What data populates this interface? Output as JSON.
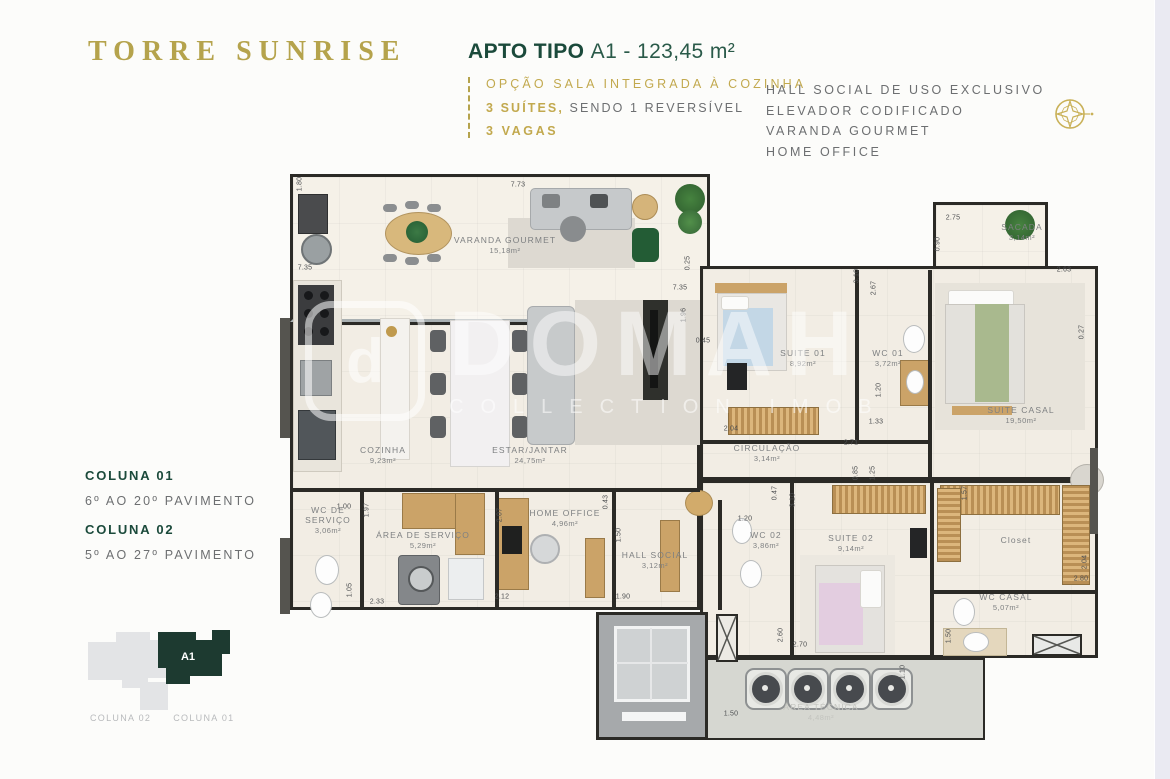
{
  "page": {
    "background": "#fcfcfa",
    "right_strip_color": "#eaeaf2"
  },
  "brand": {
    "title": "TORRE SUNRISE",
    "color": "#b5a34c"
  },
  "header": {
    "apto_label": "APTO TIPO",
    "apto_value": "A1 - 123,45 m²",
    "option_line": "OPÇÃO SALA INTEGRADA À COZINHA",
    "suites_bold": "3 SUÍTES,",
    "suites_rest": "SENDO 1 REVERSÍVEL",
    "vagas_line": "3 VAGAS"
  },
  "features": [
    "HALL SOCIAL DE USO EXCLUSIVO",
    "ELEVADOR CODIFICADO",
    "VARANDA GOURMET",
    "HOME OFFICE"
  ],
  "columns_info": [
    {
      "label": "COLUNA 01",
      "range": "6º AO 20º PAVIMENTO"
    },
    {
      "label": "COLUNA 02",
      "range": "5º AO 27º PAVIMENTO"
    }
  ],
  "keyplan": {
    "unit_label": "A1",
    "unit_color": "#1d3a30",
    "other_color": "#e3e4e6",
    "captions": [
      "COLUNA 02",
      "COLUNA 01"
    ]
  },
  "floorplan": {
    "watermark": {
      "logo_letter": "d",
      "line1": "DOMAH",
      "line2": "COLLECTION IMOB"
    },
    "rooms": [
      {
        "name": "VARANDA GOURMET",
        "area": "15,18m²",
        "x": 225,
        "y": 77
      },
      {
        "name": "SACADA",
        "area": "3,14m²",
        "x": 742,
        "y": 64
      },
      {
        "name": "COZINHA",
        "area": "9,23m²",
        "x": 103,
        "y": 287
      },
      {
        "name": "ESTAR/JANTAR",
        "area": "24,75m²",
        "x": 250,
        "y": 287
      },
      {
        "name": "SUITE 01",
        "area": "8,92m²",
        "x": 523,
        "y": 190
      },
      {
        "name": "WC 01",
        "area": "3,72m²",
        "x": 608,
        "y": 190
      },
      {
        "name": "SUITE CASAL",
        "area": "19,50m²",
        "x": 741,
        "y": 247
      },
      {
        "name": "CIRCULAÇÃO",
        "area": "3,14m²",
        "x": 487,
        "y": 285
      },
      {
        "name": "WC DE SERVIÇO",
        "area": "3,06m²",
        "x": 48,
        "y": 352,
        "wrap": true
      },
      {
        "name": "ÁREA DE SERVIÇO",
        "area": "5,29m²",
        "x": 143,
        "y": 372
      },
      {
        "name": "HOME OFFICE",
        "area": "4,96m²",
        "x": 285,
        "y": 350
      },
      {
        "name": "HALL SOCIAL",
        "area": "3,12m²",
        "x": 375,
        "y": 392
      },
      {
        "name": "WC 02",
        "area": "3,86m²",
        "x": 486,
        "y": 372
      },
      {
        "name": "SUITE 02",
        "area": "9,14m²",
        "x": 571,
        "y": 375
      },
      {
        "name": "Closet",
        "area": "",
        "x": 736,
        "y": 372
      },
      {
        "name": "WC CASAL",
        "area": "5,07m²",
        "x": 726,
        "y": 434
      },
      {
        "name": "ÁREA TÉCNICA",
        "area": "4,48m²",
        "x": 541,
        "y": 544,
        "light": true
      }
    ],
    "dimensions": [
      {
        "t": "1.80",
        "x": 20,
        "y": 16,
        "r": 1
      },
      {
        "t": "7.73",
        "x": 238,
        "y": 17,
        "r": 0
      },
      {
        "t": "7.35",
        "x": 25,
        "y": 100,
        "r": 0
      },
      {
        "t": "0.25",
        "x": 408,
        "y": 95,
        "r": 1
      },
      {
        "t": "7.35",
        "x": 400,
        "y": 120,
        "r": 0
      },
      {
        "t": "1.96",
        "x": 404,
        "y": 147,
        "r": 1
      },
      {
        "t": "2.75",
        "x": 673,
        "y": 50,
        "r": 0
      },
      {
        "t": "0.90",
        "x": 658,
        "y": 76,
        "r": 1
      },
      {
        "t": "2.63",
        "x": 784,
        "y": 102,
        "r": 0
      },
      {
        "t": "3.10",
        "x": 577,
        "y": 108,
        "r": 1
      },
      {
        "t": "2.67",
        "x": 594,
        "y": 120,
        "r": 1
      },
      {
        "t": "0.27",
        "x": 802,
        "y": 164,
        "r": 1
      },
      {
        "t": "0.45",
        "x": 423,
        "y": 173,
        "r": 0
      },
      {
        "t": "1.20",
        "x": 599,
        "y": 222,
        "r": 1
      },
      {
        "t": "2.04",
        "x": 451,
        "y": 261,
        "r": 0
      },
      {
        "t": "1.33",
        "x": 596,
        "y": 254,
        "r": 0
      },
      {
        "t": "2.71",
        "x": 571,
        "y": 275,
        "r": 0
      },
      {
        "t": "0.85",
        "x": 576,
        "y": 305,
        "r": 1
      },
      {
        "t": "1.25",
        "x": 593,
        "y": 305,
        "r": 1
      },
      {
        "t": "0.47",
        "x": 495,
        "y": 325,
        "r": 1
      },
      {
        "t": "3.10",
        "x": 513,
        "y": 332,
        "r": 1
      },
      {
        "t": "0.43",
        "x": 326,
        "y": 334,
        "r": 1
      },
      {
        "t": "1.50",
        "x": 339,
        "y": 367,
        "r": 1
      },
      {
        "t": "1.90",
        "x": 343,
        "y": 429,
        "r": 0
      },
      {
        "t": "1.00",
        "x": 64,
        "y": 339,
        "r": 0
      },
      {
        "t": "1.97",
        "x": 87,
        "y": 342,
        "r": 1
      },
      {
        "t": "1.05",
        "x": 70,
        "y": 422,
        "r": 1
      },
      {
        "t": "2.33",
        "x": 97,
        "y": 434,
        "r": 0
      },
      {
        "t": "2.07",
        "x": 220,
        "y": 347,
        "r": 1
      },
      {
        "t": "2.12",
        "x": 222,
        "y": 429,
        "r": 0
      },
      {
        "t": "1.20",
        "x": 465,
        "y": 351,
        "r": 0
      },
      {
        "t": "1.57",
        "x": 685,
        "y": 325,
        "r": 1
      },
      {
        "t": "2.04",
        "x": 805,
        "y": 394,
        "r": 1
      },
      {
        "t": "2.80",
        "x": 801,
        "y": 411,
        "r": 0
      },
      {
        "t": "1.50",
        "x": 669,
        "y": 468,
        "r": 1
      },
      {
        "t": "2.60",
        "x": 501,
        "y": 467,
        "r": 1
      },
      {
        "t": "2.70",
        "x": 520,
        "y": 477,
        "r": 0
      },
      {
        "t": "1.50",
        "x": 451,
        "y": 546,
        "r": 0
      },
      {
        "t": "1.10",
        "x": 623,
        "y": 504,
        "r": 1
      }
    ]
  }
}
